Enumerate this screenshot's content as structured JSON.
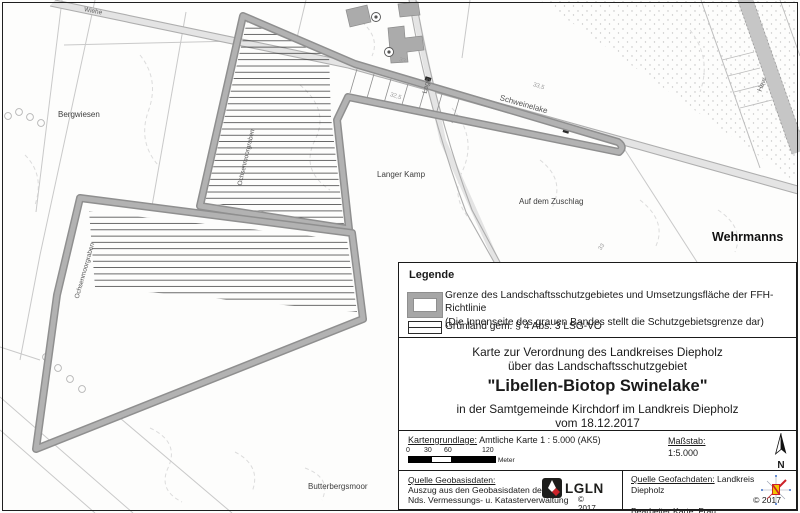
{
  "colors": {
    "band_gray": "#9a9a9a",
    "road_gray": "#bdbdbd",
    "accent_red": "#cc2229",
    "lgln_black": "#1d1d1b"
  },
  "map": {
    "labels": {
      "bergwiesen": "Bergwiesen",
      "langer_kamp": "Langer Kamp",
      "auf_dem_zuschlag": "Auf dem Zuschlag",
      "wehrmanns": "Wehrmanns",
      "butterbergsmoor": "Butterbergsmoor",
      "schweinelake": "Schweinelake",
      "graben_upper": "Ochsenmoorgraben",
      "graben_lower": "Ochsenmoorgraben",
      "lage": "Lage",
      "hew": "Hew",
      "wiehe": "Wiehe"
    },
    "contour_values": {
      "c1": "33",
      "c2": "32,5",
      "c3": "33,5",
      "c4": "33"
    }
  },
  "legend": {
    "title": "Legende",
    "band_item": {
      "line1": "Grenze des Landschaftsschutzgebietes und Umsetzungsfläche der FFH-Richtlinie",
      "line2": "(Die Innenseite des grauen Bandes stellt die Schutzgebietsgrenze dar)"
    },
    "gruenland_item": {
      "label": "Grünland gem. § 4 Abs. 3 LSG-VO"
    }
  },
  "title_block": {
    "line1": "Karte zur Verordnung des Landkreises Diepholz",
    "line2": "über das Landschaftsschutzgebiet",
    "main_title": "\"Libellen-Biotop Swinelake\"",
    "line3": "in der Samtgemeinde Kirchdorf im Landkreis Diepholz",
    "line4": "vom 18.12.2017"
  },
  "footer": {
    "map_basis_label": "Kartengrundlage:",
    "map_basis_value": " Amtliche Karte 1 : 5.000 (AK5)",
    "scalebar": {
      "ticks": [
        "0",
        "30",
        "60",
        "120"
      ],
      "unit": "Meter"
    },
    "scale_label": "Maßstab:",
    "scale_value": "1:5.000",
    "north_label": "N",
    "geobasis_label": "Quelle Geobasisdaten:",
    "geobasis_line1": "Auszug aus den Geobasisdaten der",
    "geobasis_line2": "Nds. Vermessungs- u. Katasterverwaltung",
    "lgln_logo_text": "LGLN",
    "lgln_copyright": "© 2017",
    "geofach_label": "Quelle Geofachdaten:",
    "geofach_value": " Landkreis Diepholz",
    "geofach_copyright": "© 2017",
    "editor_label": "Bearbeiter Karte:",
    "editor_value": " Frau Scharninghausen"
  }
}
